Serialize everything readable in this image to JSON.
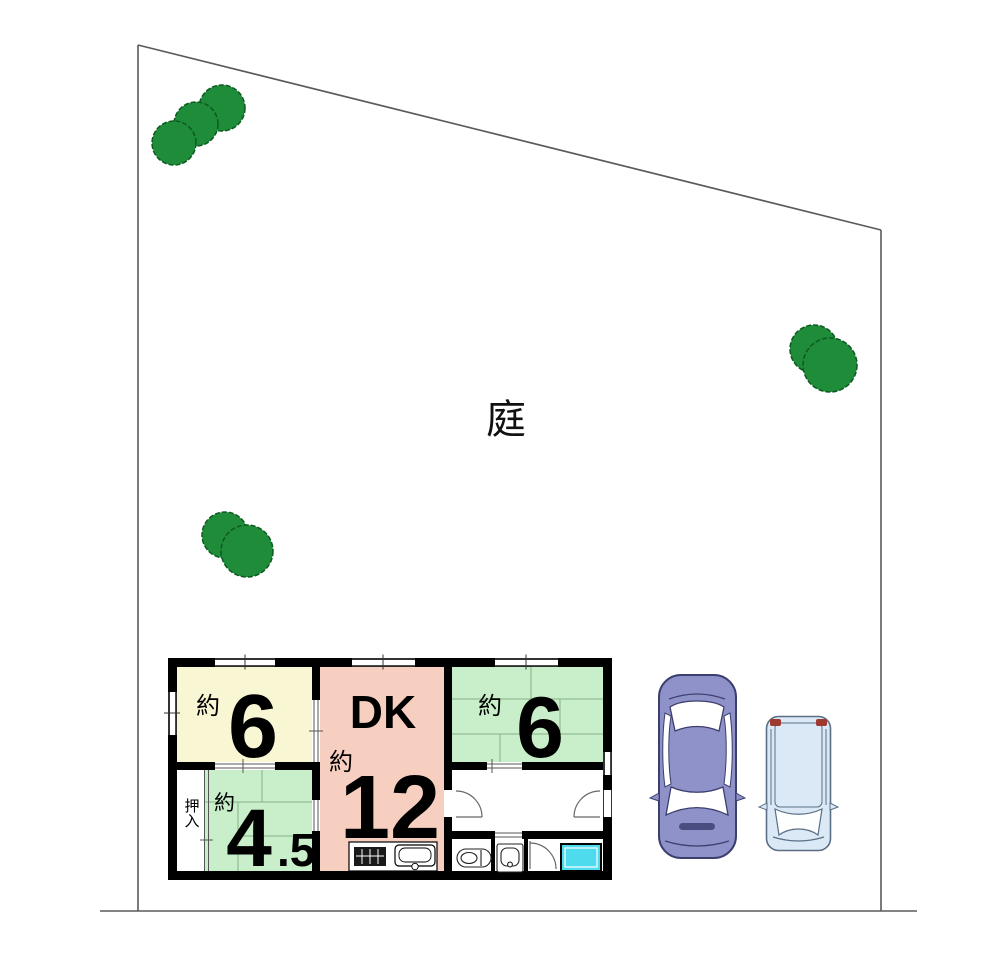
{
  "site": {
    "garden_label": "庭",
    "boundary_color": "#5a5a5a",
    "tree_color": "#1f8c3a",
    "tree_outline": "#0c5a20"
  },
  "floorplan": {
    "wall_color": "#000000",
    "bath_fill": "#4ddbed",
    "rooms": [
      {
        "key": "japanese-room-northwest",
        "approx": "約",
        "size": "6",
        "fill": "#f9f6d3"
      },
      {
        "key": "dining-kitchen",
        "title": "DK",
        "approx": "約",
        "size": "12",
        "fill": "#f7cfc0"
      },
      {
        "key": "japanese-room-northeast",
        "approx": "約",
        "size": "6",
        "fill": "#c9efca"
      },
      {
        "key": "japanese-room-southwest",
        "approx": "約",
        "size_main": "4",
        "size_sub": ".5",
        "fill": "#c9efca"
      },
      {
        "key": "closet",
        "label": "押入"
      }
    ]
  },
  "vehicles": {
    "sedan_fill": "#8f91c9",
    "sedan_outline": "#3c3f6e",
    "compact_fill": "#dbe9f6",
    "compact_outline": "#5a6f85",
    "compact_taillight": "#a0392f"
  }
}
